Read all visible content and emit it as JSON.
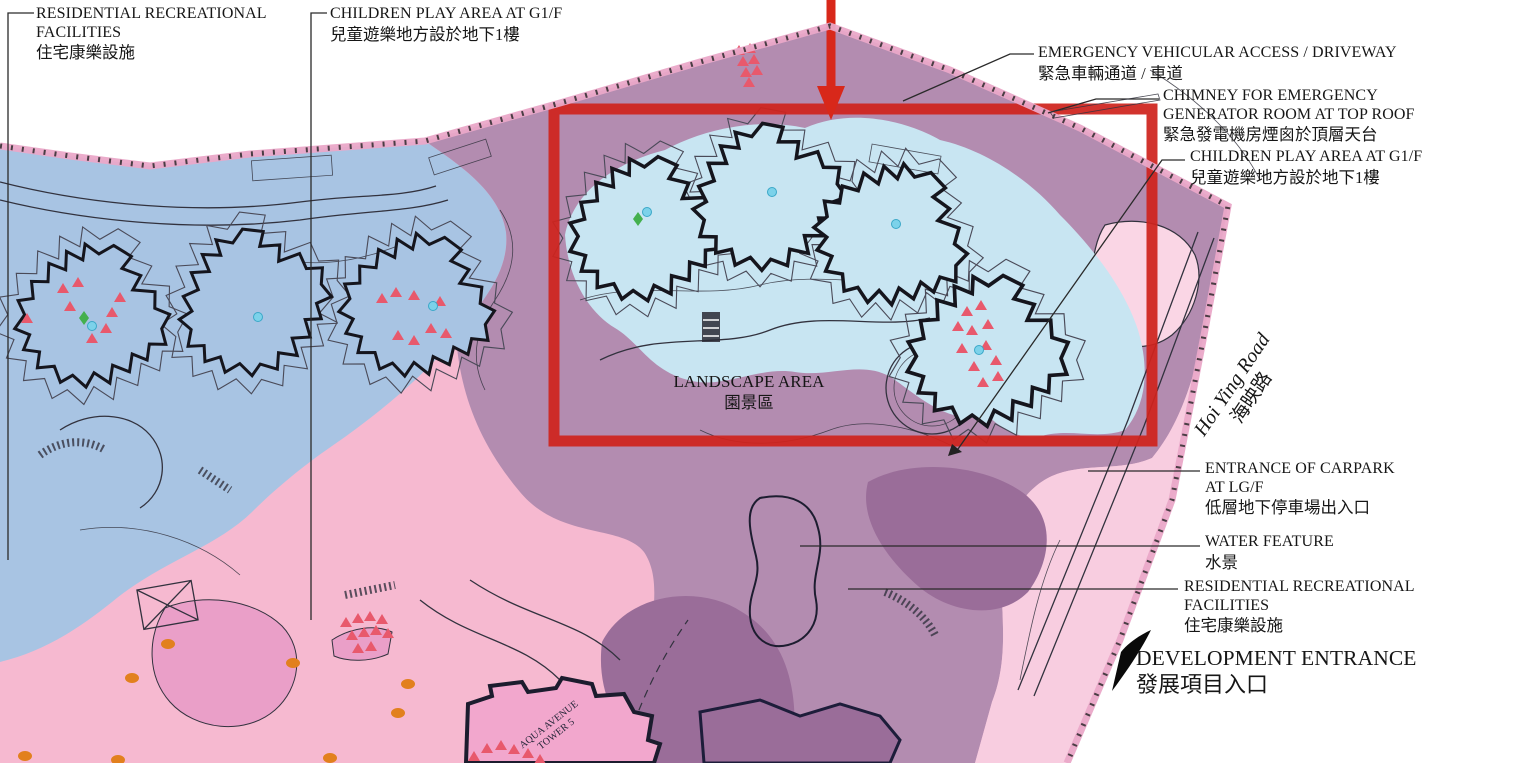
{
  "canvas": {
    "width": 1531,
    "height": 763
  },
  "colors": {
    "zone_blue": "#a8c4e3",
    "zone_mauve": "#b38cb0",
    "zone_pink": "#f6b9d0",
    "zone_pink_light": "#f8cde0",
    "zone_pink_lighter": "#fad6e5",
    "zone_pink_medium": "#ea9fc8",
    "zone_purple_dark": "#9a6d99",
    "podium_blue": "#c8e5f2",
    "tower_pink": "#f2a7cd",
    "highlight_red": "#cf241d",
    "arrow_red": "#d8281a",
    "tree_red": "#e8596c",
    "dot_cyan": "#7cd2ea",
    "dot_orange": "#e2801e",
    "diamond_green": "#44b04e",
    "line_ink": "#32323e",
    "boundary_pink": "#eaa8c8"
  },
  "labels": {
    "residential_recreational_left": {
      "line1": "RESIDENTIAL RECREATIONAL",
      "line2": "FACILITIES",
      "line3": "住宅康樂設施"
    },
    "children_play_top": {
      "line1": "CHILDREN PLAY AREA AT G1/F",
      "line2": "兒童遊樂地方設於地下1樓"
    },
    "emergency_vehicular_access": {
      "line1": "EMERGENCY VEHICULAR ACCESS / DRIVEWAY",
      "line2": "緊急車輛通道 / 車道"
    },
    "chimney": {
      "line1": "CHIMNEY FOR EMERGENCY",
      "line2": "GENERATOR ROOM AT TOP ROOF",
      "line3": "緊急發電機房煙囪於頂層天台"
    },
    "children_play_right": {
      "line1": "CHILDREN PLAY AREA AT G1/F",
      "line2": "兒童遊樂地方設於地下1樓"
    },
    "landscape_area": {
      "line1": "LANDSCAPE AREA",
      "line2": "園景區"
    },
    "hoi_ying_road": {
      "line1": "Hoi Ying Road",
      "line2": "海映路"
    },
    "carpark_entrance": {
      "line1": "ENTRANCE OF CARPARK",
      "line2": "AT LG/F",
      "line3": "低層地下停車場出入口"
    },
    "water_feature": {
      "line1": "WATER FEATURE",
      "line2": "水景"
    },
    "residential_recreational_right": {
      "line1": "RESIDENTIAL RECREATIONAL",
      "line2": "FACILITIES",
      "line3": "住宅康樂設施"
    },
    "development_entrance": {
      "line1": "DEVELOPMENT ENTRANCE",
      "line2": "發展項目入口"
    },
    "tower_name": {
      "line1": "AQUA AVENUE",
      "line2": "TOWER 5"
    }
  }
}
